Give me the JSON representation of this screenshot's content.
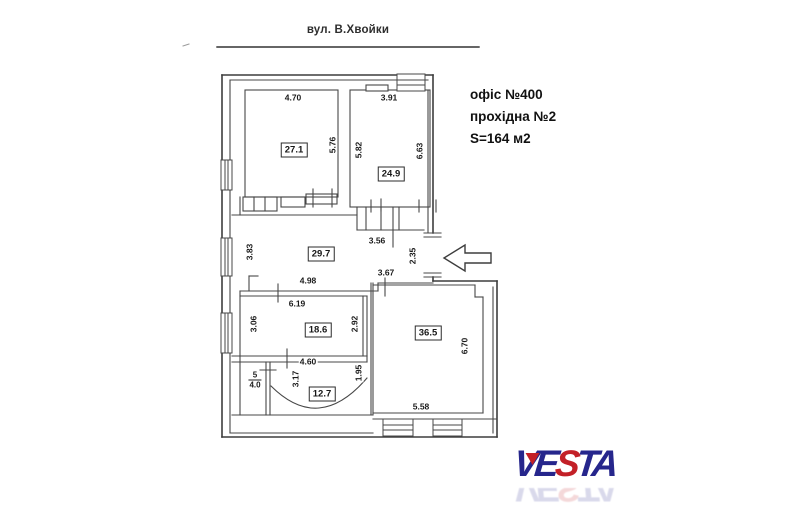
{
  "header": {
    "street_label": "вул. В.Хвойки"
  },
  "info_block": {
    "lines": [
      "офіс №400",
      "прохідна №2",
      "S=164 м2"
    ]
  },
  "plan": {
    "type": "floor-plan",
    "rooms": [
      {
        "name": "room-27-1",
        "area_label": "27.1",
        "x": 294,
        "y": 150
      },
      {
        "name": "room-24-9",
        "area_label": "24.9",
        "x": 391,
        "y": 174
      },
      {
        "name": "room-29-7",
        "area_label": "29.7",
        "x": 321,
        "y": 254
      },
      {
        "name": "room-18-6",
        "area_label": "18.6",
        "x": 318,
        "y": 330
      },
      {
        "name": "room-36-5",
        "area_label": "36.5",
        "x": 428,
        "y": 333
      },
      {
        "name": "room-12-7",
        "area_label": "12.7",
        "x": 322,
        "y": 394
      }
    ],
    "small_room": {
      "top": "5",
      "bottom": "4.0",
      "x": 255,
      "y": 380
    },
    "dimensions": [
      {
        "text": "4.70",
        "x": 293,
        "y": 98,
        "vertical": false
      },
      {
        "text": "3.91",
        "x": 389,
        "y": 98,
        "vertical": false
      },
      {
        "text": "5.76",
        "x": 333,
        "y": 145,
        "vertical": true
      },
      {
        "text": "5.82",
        "x": 359,
        "y": 150,
        "vertical": true
      },
      {
        "text": "6.63",
        "x": 420,
        "y": 151,
        "vertical": true
      },
      {
        "text": "3.56",
        "x": 377,
        "y": 241,
        "vertical": false
      },
      {
        "text": "2.35",
        "x": 413,
        "y": 256,
        "vertical": true
      },
      {
        "text": "3.83",
        "x": 250,
        "y": 252,
        "vertical": true
      },
      {
        "text": "4.98",
        "x": 308,
        "y": 281,
        "vertical": false
      },
      {
        "text": "3.67",
        "x": 386,
        "y": 273,
        "vertical": false
      },
      {
        "text": "6.19",
        "x": 297,
        "y": 304,
        "vertical": false
      },
      {
        "text": "3.06",
        "x": 254,
        "y": 324,
        "vertical": true
      },
      {
        "text": "2.92",
        "x": 355,
        "y": 324,
        "vertical": true
      },
      {
        "text": "4.60",
        "x": 308,
        "y": 362,
        "vertical": false
      },
      {
        "text": "3.17",
        "x": 296,
        "y": 379,
        "vertical": true
      },
      {
        "text": "1.95",
        "x": 359,
        "y": 373,
        "vertical": true
      },
      {
        "text": "5.58",
        "x": 421,
        "y": 407,
        "vertical": false
      },
      {
        "text": "6.70",
        "x": 465,
        "y": 346,
        "vertical": true
      }
    ],
    "entrance_arrow": "left-arrow"
  },
  "logo": {
    "text": "VESTA",
    "letters": [
      {
        "char": "V",
        "color_key": "navy"
      },
      {
        "char": "E",
        "color_key": "navy"
      },
      {
        "char": "S",
        "color_key": "red"
      },
      {
        "char": "T",
        "color_key": "navy"
      },
      {
        "char": "A",
        "color_key": "navy"
      }
    ],
    "navy": "#26268c",
    "red": "#c32027"
  },
  "colors": {
    "background": "#ffffff",
    "wall_line": "#3d3d3d",
    "thin_line": "#4a4a4a",
    "text": "#1b1b1b"
  }
}
